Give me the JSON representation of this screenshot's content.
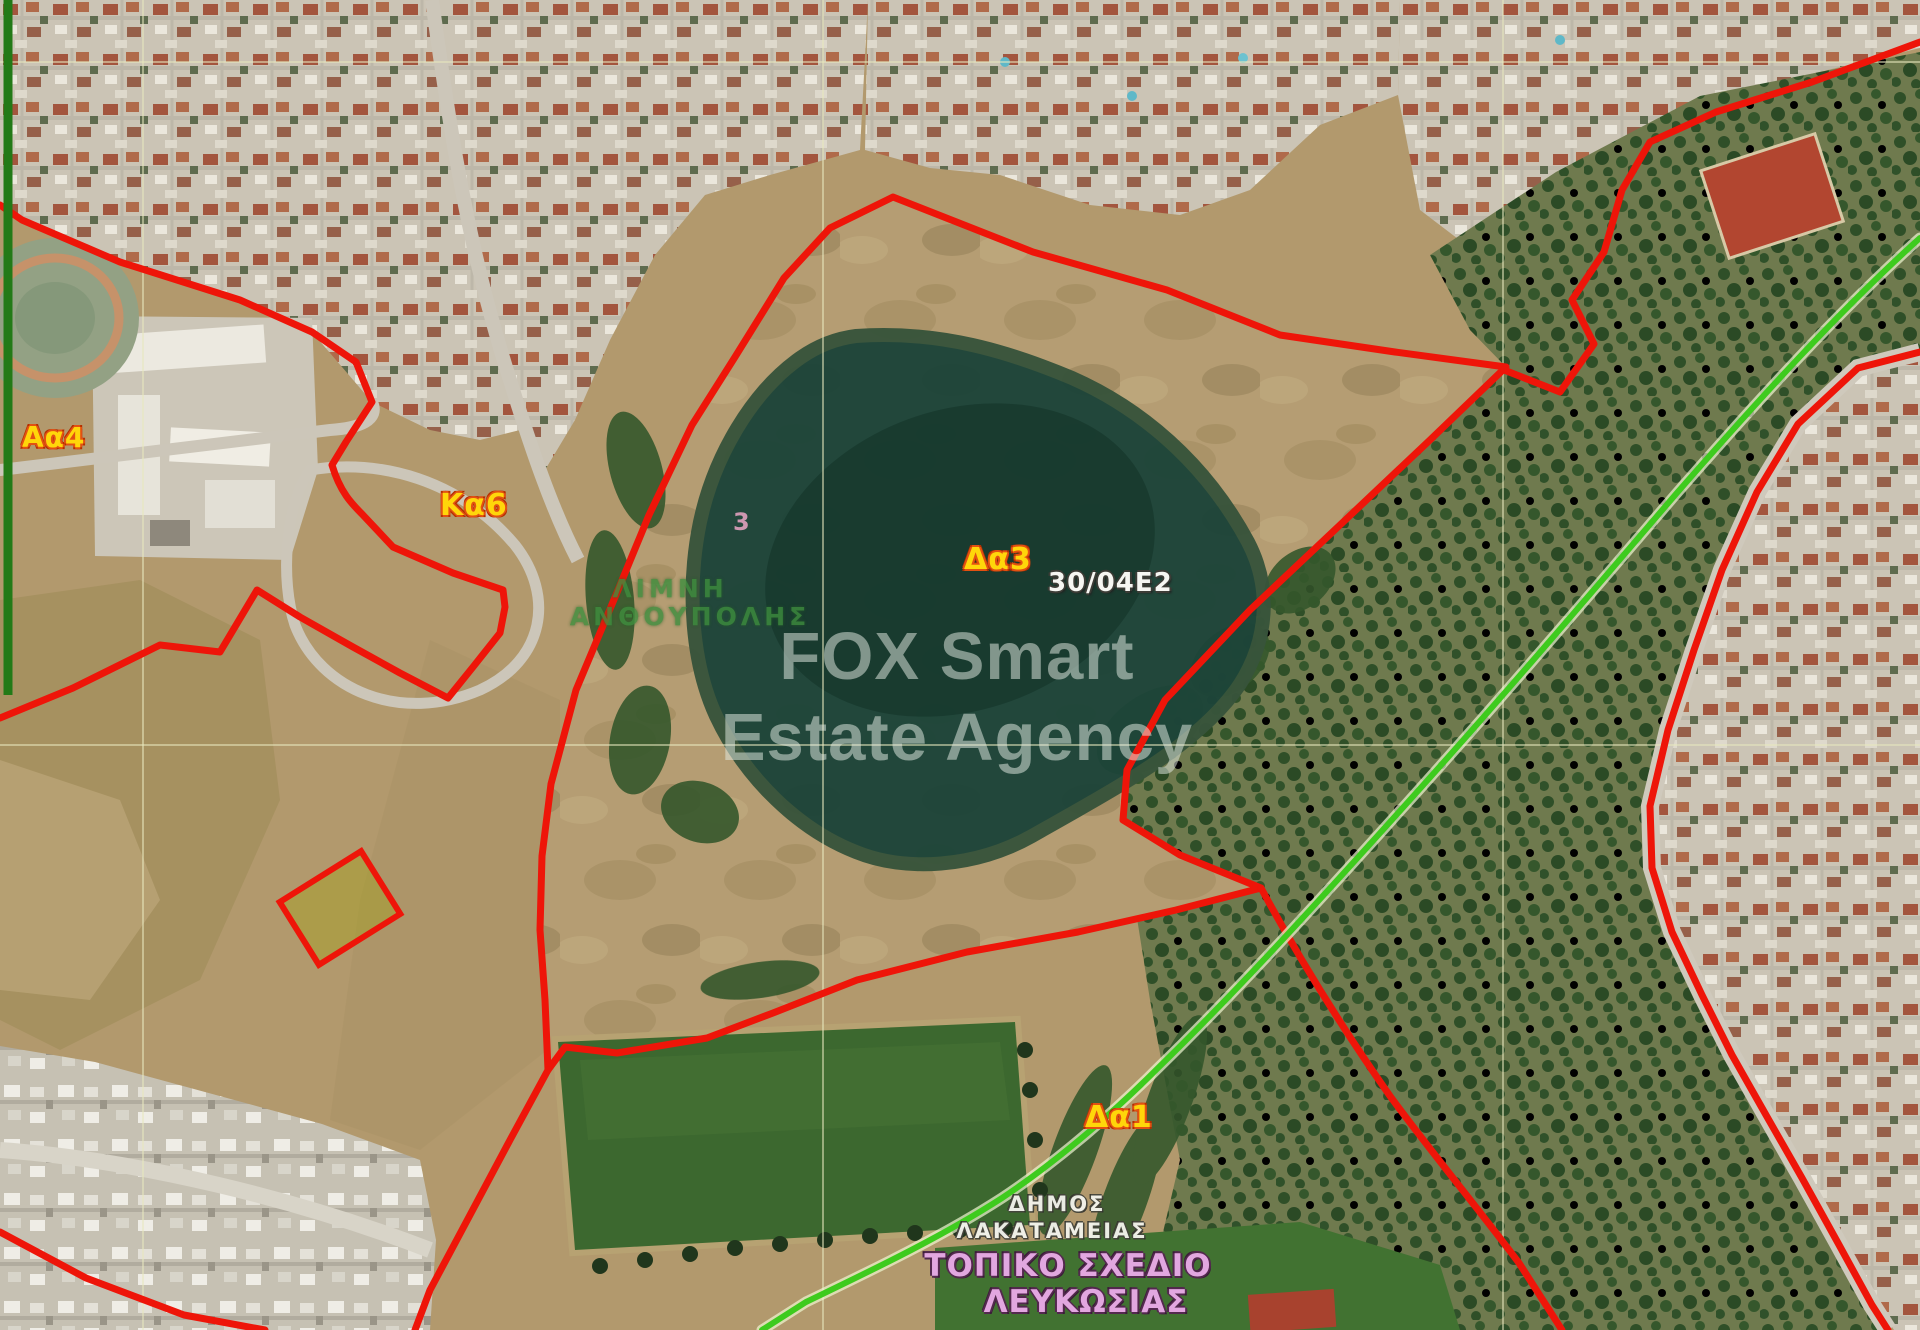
{
  "map": {
    "watermark": {
      "line1": "FOX Smart",
      "line2": "Estate Agency"
    },
    "labels": {
      "zone_aa4": "Αα4",
      "zone_ka6": "Κα6",
      "zone_da3": "Δα3",
      "sheet_code": "30/04Ε2",
      "zone_da1": "Δα1",
      "area_name_line1": "ΛΙΜΝΗ",
      "area_name_line2": "ΑΝΘΟΥΠΟΛΗΣ",
      "grid_number": "3",
      "municipality_line1": "ΔΗΜΟΣ",
      "municipality_line2": "ΛΑΚΑΤΑΜΕΙΑΣ",
      "plan_line1": "ΤΟΠΙΚΟ ΣΧΕΔΙΟ",
      "plan_line2": "ΛΕΥΚΩΣΙΑΣ"
    },
    "colors": {
      "boundary_red": "#ee1509",
      "path_green": "#3ecb1e",
      "edge_line_dark_green": "#237a17",
      "zone_label_yellow": "#ffd60a",
      "zone_label_outline_orange": "#e25112",
      "plan_label_pink": "#e2a7e0",
      "municipality_label_white": "#f4f4ee",
      "area_label_green": "#3e8e3e",
      "pond_dark_green": "#1d4539",
      "terrain_tan": "#b59d73",
      "sports_field_green": "#3c682f",
      "grid_line_khaki": "#e8e8be"
    }
  }
}
